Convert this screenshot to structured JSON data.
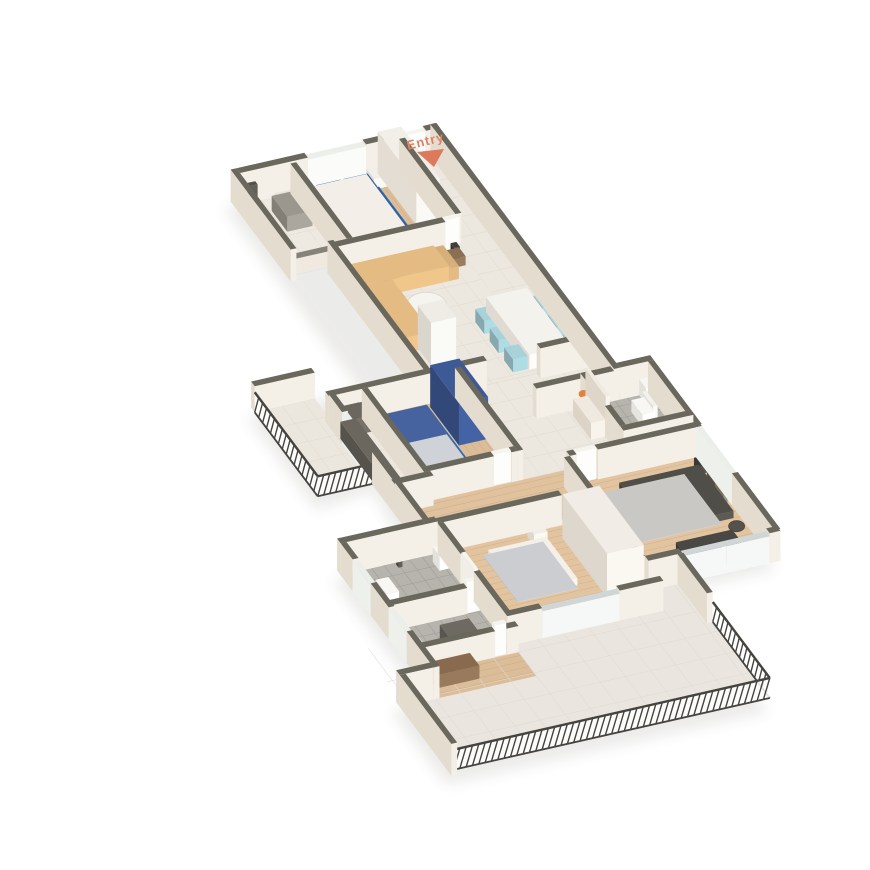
{
  "scene": {
    "title": "3D isometric apartment floor plan render",
    "entry": {
      "label": "Entry",
      "text_color": "#dd8266",
      "arrow_color": "#dd7a5c"
    },
    "palette": {
      "wall_cap": "#6a675d",
      "wall_side_light": "#f4efe7",
      "wall_side_shade": "#e5dcd0",
      "wood_floor": "#dcbd9a",
      "wood_line": "#c4a077",
      "tile_floor": "#ece7df",
      "grey_tile": "#b7b4ae",
      "marble": "#eae6df",
      "railing": "#45443f",
      "glass_door": "#cfd6d5"
    },
    "rooms": [
      {
        "id": "utility-balcony",
        "features": [
          "wash-basin",
          "wall-tap",
          "parapet-ledge"
        ]
      },
      {
        "id": "bedroom-1",
        "floor": "wood",
        "bed_color": "#2f63a6",
        "furniture": [
          "double-bed",
          "pillows",
          "white-wardrobe",
          "nightstand",
          "tv-unit"
        ]
      },
      {
        "id": "living-room",
        "floor": "tile",
        "sofa_color": "#e3bb83",
        "furniture": [
          "l-shaped-sofa",
          "round-coffee-table",
          "side-table-lamp"
        ]
      },
      {
        "id": "dining-area",
        "floor": "tile",
        "chair_color": "#a8d2da",
        "furniture": [
          "dining-table",
          "six-chairs",
          "six-place-settings",
          "fridge"
        ]
      },
      {
        "id": "kitchen",
        "counter_color": "#6b675f",
        "furniture": [
          "l-counter",
          "gas-hob",
          "kettle",
          "jars"
        ]
      },
      {
        "id": "balcony-left",
        "features": [
          "railing"
        ]
      },
      {
        "id": "bedroom-2",
        "floor": "wood",
        "bed_color": "#aadde2",
        "bed_frame_color": "#47639f",
        "wardrobe_color": "#3d5a96",
        "furniture": [
          "double-bed",
          "rug",
          "blue-wardrobe",
          "tv-unit",
          "nightstand"
        ]
      },
      {
        "id": "foyer",
        "furniture": [
          "console-table",
          "flower-vase",
          "wall-panel"
        ]
      },
      {
        "id": "bathroom-1",
        "floor": "grey-tile",
        "fixtures": [
          "toilet",
          "wash-basin"
        ]
      },
      {
        "id": "bedroom-3",
        "floor": "wood",
        "bed_color": "#e9c34e",
        "furniture": [
          "double-bed",
          "rug",
          "dresser",
          "nightstand-lamp",
          "wall-art",
          "pouf"
        ]
      },
      {
        "id": "bedroom-4",
        "floor": "wood",
        "bed_color": "#de7b5f",
        "furniture": [
          "double-bed",
          "nightstand-lamp",
          "sliding-wardrobe"
        ]
      },
      {
        "id": "bathroom-2",
        "floor": "grey-tile",
        "fixtures": [
          "toilet",
          "wash-basin",
          "shower"
        ]
      },
      {
        "id": "bathroom-3",
        "floor": "grey-tile",
        "fixtures": [
          "vanity-counter",
          "toilet"
        ]
      },
      {
        "id": "study-nook",
        "floor": "wood",
        "furniture": [
          "desk"
        ]
      },
      {
        "id": "terrace",
        "floor": "marble",
        "features": [
          "railing"
        ]
      }
    ]
  }
}
